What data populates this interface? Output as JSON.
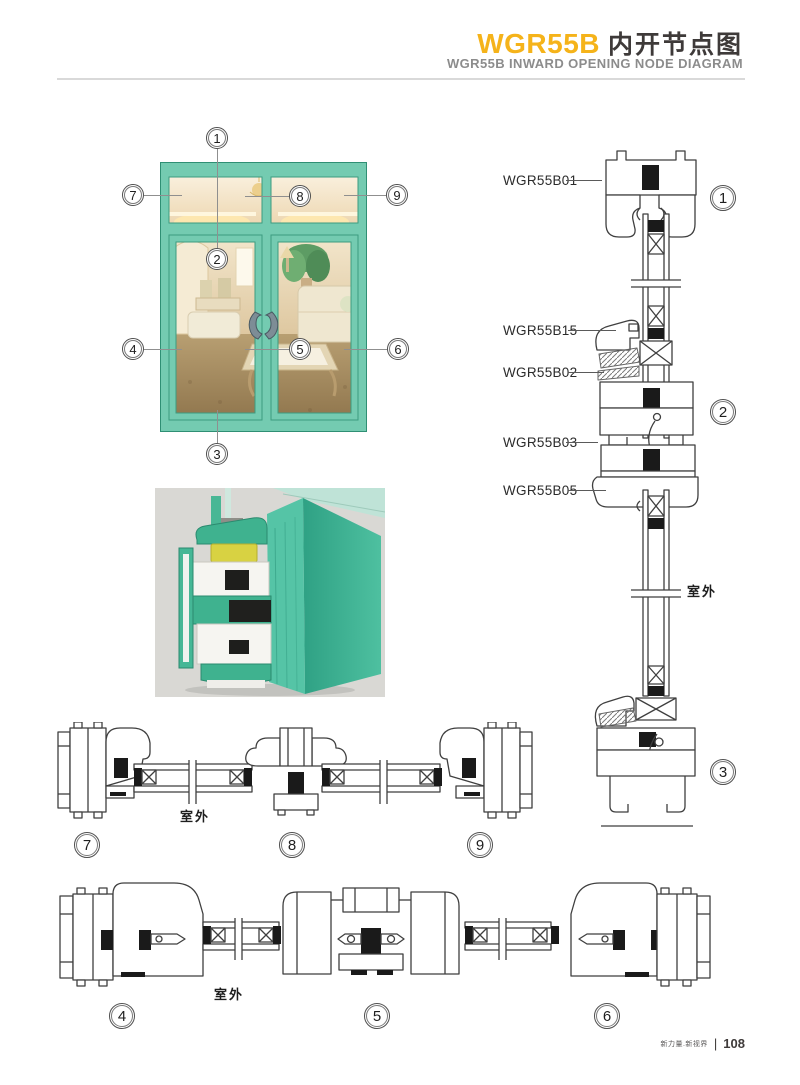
{
  "header": {
    "product_code": "WGR55B",
    "title_cn": "内开节点图",
    "subtitle": "WGR55B INWARD OPENING NODE DIAGRAM"
  },
  "colors": {
    "accent_yellow": "#F5B31A",
    "frame_teal": "#74CBB1",
    "drawing_line": "#3F3F3F",
    "divider_gray": "#D9D9D9"
  },
  "window_figure": {
    "callouts": [
      "1",
      "2",
      "3",
      "4",
      "5",
      "6",
      "7",
      "8",
      "9"
    ]
  },
  "vertical_section": {
    "labels": [
      "WGR55B01",
      "WGR55B15",
      "WGR55B02",
      "WGR55B03",
      "WGR55B05"
    ],
    "markers": [
      "1",
      "2",
      "3"
    ],
    "outdoor": "室外"
  },
  "top_horizontal_section": {
    "markers": [
      "7",
      "8",
      "9"
    ],
    "outdoor": "室外"
  },
  "bottom_horizontal_section": {
    "markers": [
      "4",
      "5",
      "6"
    ],
    "outdoor": "室外"
  },
  "footer": {
    "brand": "新力量.新视界",
    "divider": "|",
    "page": "108"
  }
}
